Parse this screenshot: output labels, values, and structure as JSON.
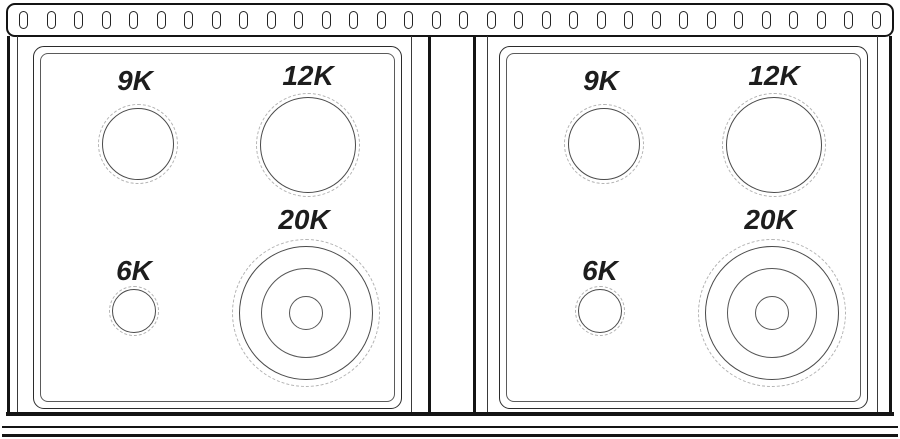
{
  "vent": {
    "slot_count": 32
  },
  "panels": [
    {
      "name": "left",
      "burners": [
        {
          "label": "9K"
        },
        {
          "label": "12K"
        },
        {
          "label": "6K"
        },
        {
          "label": "20K"
        }
      ]
    },
    {
      "name": "right",
      "burners": [
        {
          "label": "9K"
        },
        {
          "label": "12K"
        },
        {
          "label": "6K"
        },
        {
          "label": "20K"
        }
      ]
    }
  ],
  "colors": {
    "line": "#141414",
    "panel_line": "#2b2b2b",
    "ring_line": "#4a4a4a",
    "dashed_line": "#b3b3b3",
    "label_text": "#1d1d1d",
    "background": "#ffffff"
  }
}
